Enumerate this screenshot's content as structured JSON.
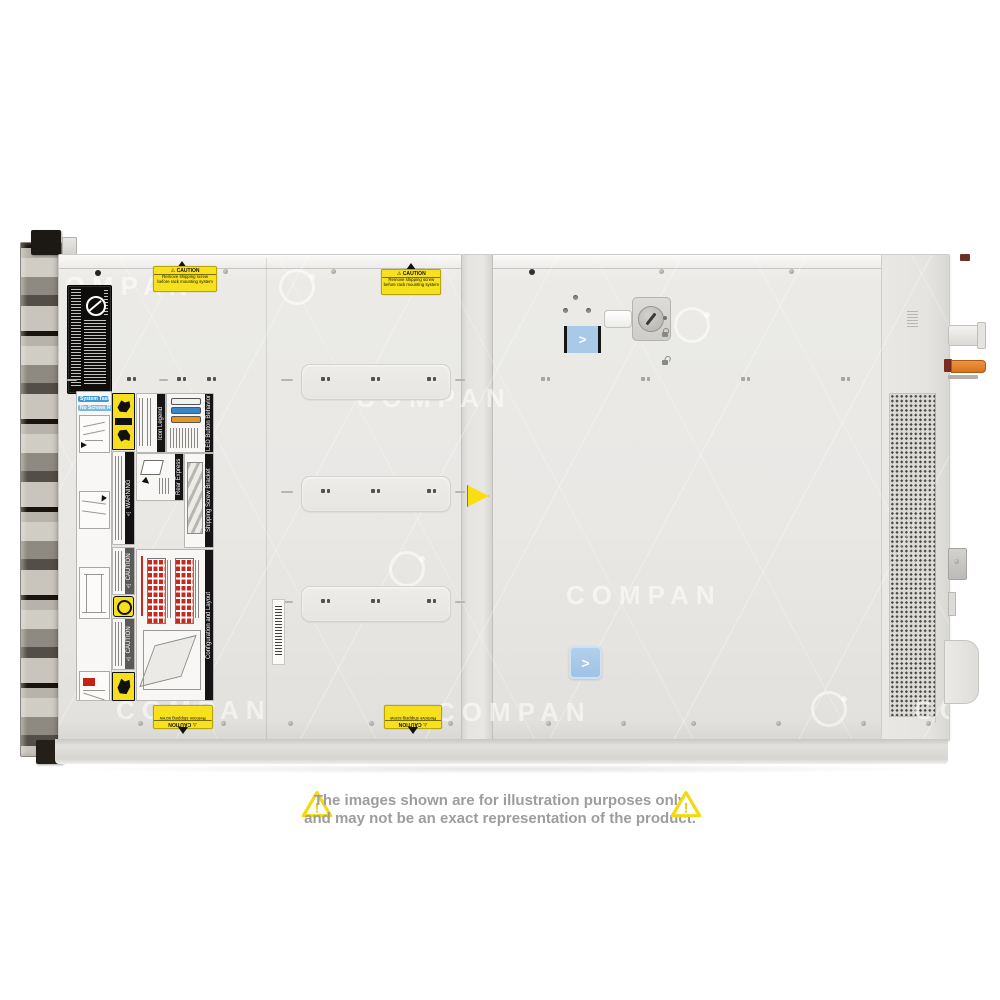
{
  "disclaimer": {
    "line1": "The images shown are for illustration purposes only",
    "line2": "and may not be an exact representation of the product.",
    "mark": "!"
  },
  "watermark": {
    "text": "COMPAN"
  },
  "stickers": {
    "caution_top": {
      "warn": "⚠",
      "title": "⚠ CAUTION",
      "line1": "Remove shipping screw",
      "line2": "before rack mounting system"
    },
    "panel": {
      "system_tasks": "System Tasks",
      "no_screws": "No Screws Required!",
      "warning": "⚠ WARNING",
      "icon_legend": "Icon Legend",
      "led_behavior": "LED Button Behavior",
      "rear_tag": "Rear Express Service Tag",
      "shipping_bracket": "Shipping Screw Bracket",
      "config_layout": "Configuration and Layout",
      "caution": "⚠ CAUTION"
    },
    "chevron": ">"
  },
  "colors": {
    "led_bars": [
      "#f2f1ee",
      "#3a85c8",
      "#e8951d"
    ],
    "accent_blue": "#a9c9e9",
    "caution_yellow": "#f6e11c",
    "drive_red": "#c72a1c"
  }
}
